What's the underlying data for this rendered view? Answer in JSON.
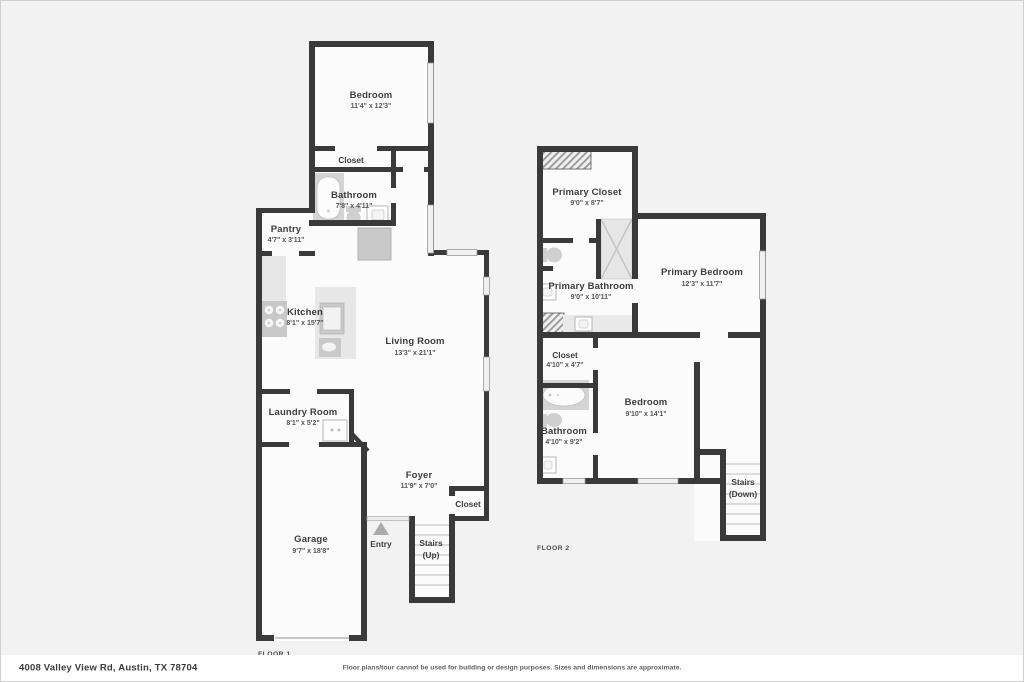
{
  "address_bar": {
    "address": "4008 Valley View Rd, Austin, TX 78704",
    "disclaimer": "Floor plans/tour cannot be used for building or design purposes. Sizes and dimensions are approximate."
  },
  "floor1": {
    "label": "FLOOR 1",
    "rooms": {
      "bedroom": {
        "name": "Bedroom",
        "dims": "11'4\" x 12'3\""
      },
      "closet": {
        "name": "Closet"
      },
      "bathroom": {
        "name": "Bathroom",
        "dims": "7'8\" x 4'11\""
      },
      "pantry": {
        "name": "Pantry",
        "dims": "4'7\" x 3'11\""
      },
      "kitchen": {
        "name": "Kitchen",
        "dims": "8'1\" x 15'7\""
      },
      "living_room": {
        "name": "Living Room",
        "dims": "13'3\" x 21'1\""
      },
      "laundry_room": {
        "name": "Laundry Room",
        "dims": "8'1\" x 5'2\""
      },
      "garage": {
        "name": "Garage",
        "dims": "9'7\" x 18'8\""
      },
      "foyer": {
        "name": "Foyer",
        "dims": "11'9\" x 7'0\""
      },
      "entry": {
        "name": "Entry"
      },
      "stairs": {
        "name": "Stairs",
        "direction": "(Up)"
      },
      "foyer_closet": {
        "name": "Closet"
      }
    }
  },
  "floor2": {
    "label": "FLOOR 2",
    "rooms": {
      "primary_closet": {
        "name": "Primary Closet",
        "dims": "9'0\" x 8'7\""
      },
      "primary_bathroom": {
        "name": "Primary Bathroom",
        "dims": "9'0\" x 10'11\""
      },
      "primary_bedroom": {
        "name": "Primary Bedroom",
        "dims": "12'3\" x 11'7\""
      },
      "closet": {
        "name": "Closet",
        "dims": "4'10\" x 4'7\""
      },
      "bedroom": {
        "name": "Bedroom",
        "dims": "9'10\" x 14'1\""
      },
      "bathroom": {
        "name": "Bathroom",
        "dims": "4'10\" x 9'2\""
      },
      "stairs": {
        "name": "Stairs",
        "direction": "(Down)"
      }
    }
  },
  "icons": [
    "bathtub-icon",
    "toilet-icon",
    "sink-icon",
    "stove-icon",
    "kitchen-island-icon",
    "refrigerator-icon",
    "washer-icon",
    "shower-icon",
    "entry-arrow-icon",
    "stairs-treads",
    "window-marker",
    "hatched-opening"
  ],
  "colors": {
    "wall": "#3a3a3a",
    "floor": "#fbfbfb",
    "background": "#f2f2f2",
    "fixture": "#d4d4d4",
    "counter": "#e7e7e7",
    "window": "#f0f0f0",
    "text": "#3d3d3d"
  }
}
